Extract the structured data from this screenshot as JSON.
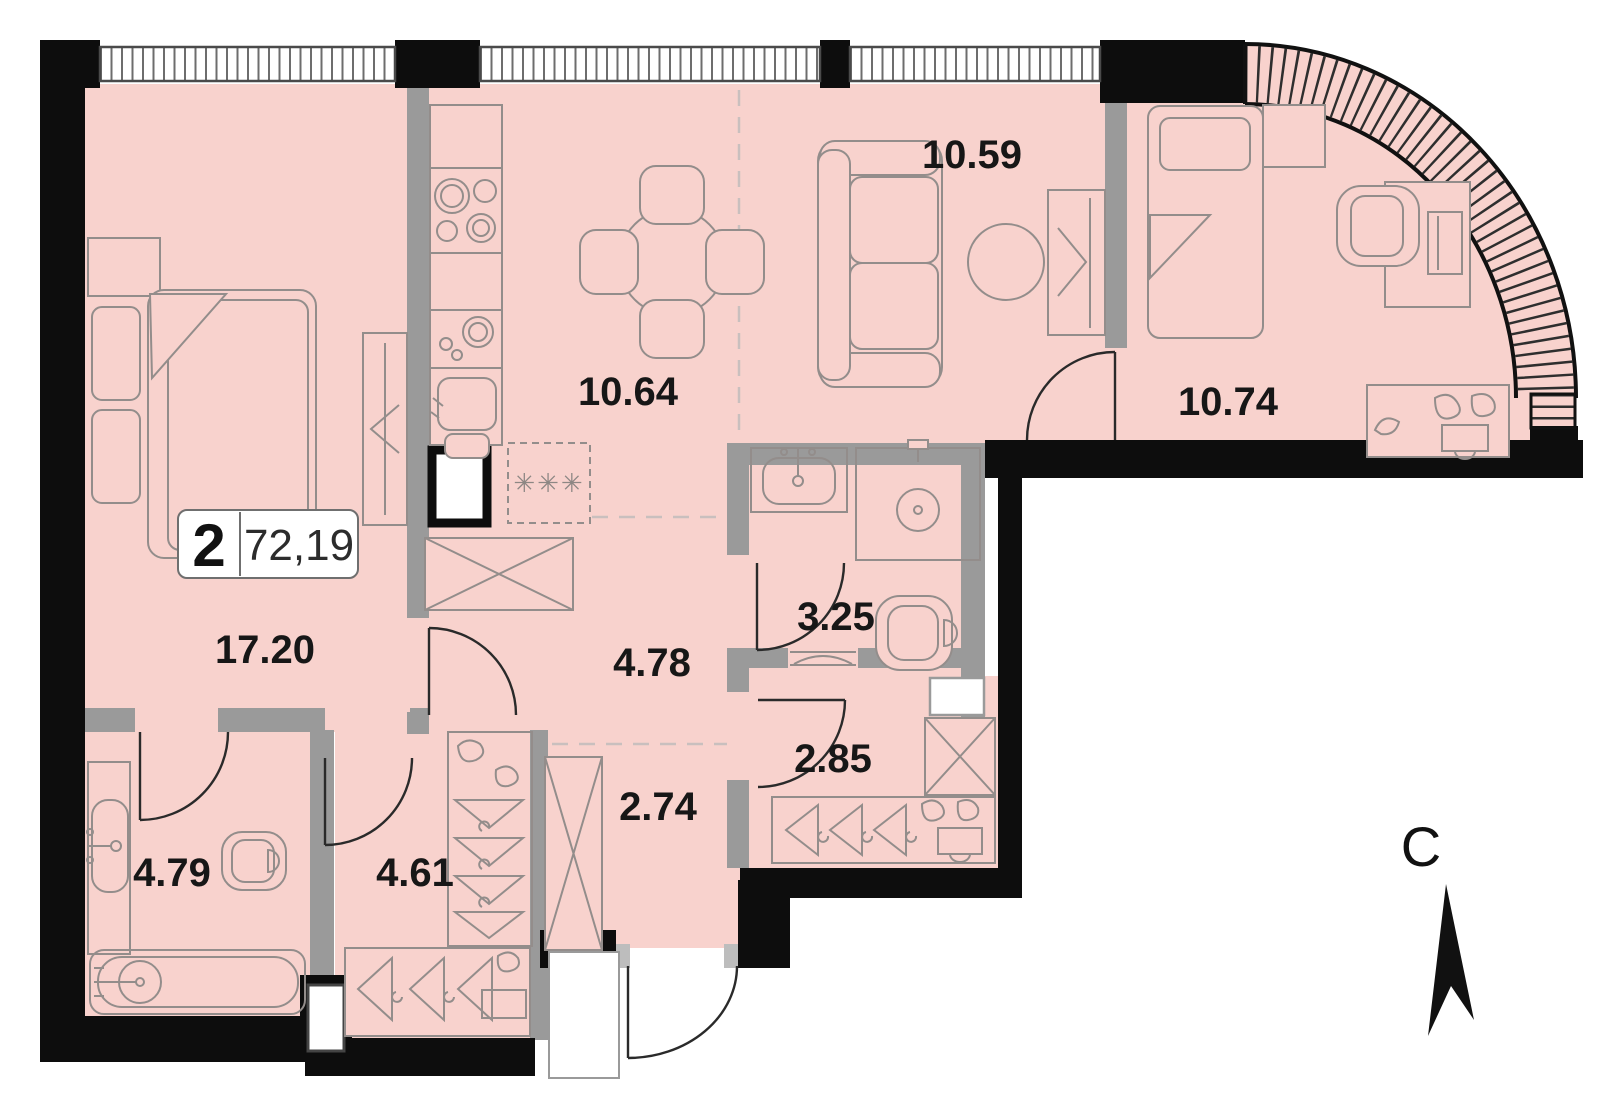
{
  "plan": {
    "badge": {
      "rooms": "2",
      "total_area": "72,19"
    },
    "north_label": "С",
    "rooms": [
      {
        "id": "living-room",
        "area": "10.59"
      },
      {
        "id": "kitchen-dining",
        "area": "10.64"
      },
      {
        "id": "bedroom-right",
        "area": "10.74"
      },
      {
        "id": "bedroom-left",
        "area": "17.20"
      },
      {
        "id": "corridor",
        "area": "4.78"
      },
      {
        "id": "shower-room",
        "area": "3.25"
      },
      {
        "id": "hall",
        "area": "2.85"
      },
      {
        "id": "entry-hall",
        "area": "2.74"
      },
      {
        "id": "wardrobe-room",
        "area": "4.61"
      },
      {
        "id": "bathroom",
        "area": "4.79"
      }
    ],
    "fridge_symbol": "✳✳✳",
    "colors": {
      "room_fill": "#f8d2cd",
      "exterior_wall": "#0d0d0d",
      "interior_wall": "#9a9a9a",
      "furniture_line": "#938d8b"
    }
  }
}
